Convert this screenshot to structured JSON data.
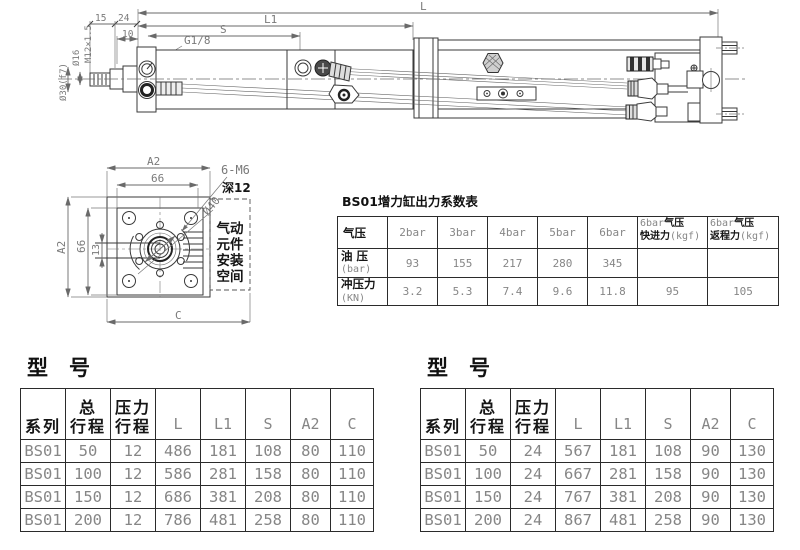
{
  "side_view": {
    "L": "L",
    "L1": "L1",
    "S": "S",
    "d10": "10",
    "d15": "15",
    "d24": "24",
    "port": "G1/8",
    "rod_thread": "M12×1.5",
    "rod_dia": "Ø16",
    "shaft_dia": "Ø30(f7)"
  },
  "end_view": {
    "a2_top": "A2",
    "w66_top": "66",
    "a2_left": "A2",
    "w66_left": "66",
    "d13": "13",
    "c": "C",
    "holes": "6-M6",
    "depth": "深12",
    "dia40": "Ø40",
    "note": [
      "气动",
      "元件",
      "安装",
      "空间"
    ]
  },
  "force_table": {
    "title": "BS01增力缸出力系数表",
    "headers": [
      "气压",
      "2bar",
      "3bar",
      "4bar",
      "5bar",
      "6bar"
    ],
    "h_fast": {
      "pre": "6bar",
      "cn1": "气压",
      "cn2": "快进力",
      "unit": "(kgf)"
    },
    "h_ret": {
      "pre": "6bar",
      "cn1": "气压",
      "cn2": "返程力",
      "unit": "(kgf)"
    },
    "row_oil": {
      "label": "油 压",
      "unit": "(bar)",
      "values": [
        "93",
        "155",
        "217",
        "280",
        "345",
        "",
        ""
      ]
    },
    "row_punch": {
      "label": "冲压力",
      "unit": "(KN)",
      "values": [
        "3.2",
        "5.3",
        "7.4",
        "9.6",
        "11.8",
        "95",
        "105"
      ]
    }
  },
  "model_tables": [
    {
      "title": "型　号",
      "headers": {
        "series": "系列",
        "stroke": "总\n行程",
        "pstroke": "压力\n行程",
        "L": "L",
        "L1": "L1",
        "S": "S",
        "A2": "A2",
        "C": "C"
      },
      "rows": [
        [
          "BS01",
          "50",
          "12",
          "486",
          "181",
          "108",
          "80",
          "110"
        ],
        [
          "BS01",
          "100",
          "12",
          "586",
          "281",
          "158",
          "80",
          "110"
        ],
        [
          "BS01",
          "150",
          "12",
          "686",
          "381",
          "208",
          "80",
          "110"
        ],
        [
          "BS01",
          "200",
          "12",
          "786",
          "481",
          "258",
          "80",
          "110"
        ]
      ]
    },
    {
      "title": "型　号",
      "headers": {
        "series": "系列",
        "stroke": "总\n行程",
        "pstroke": "压力\n行程",
        "L": "L",
        "L1": "L1",
        "S": "S",
        "A2": "A2",
        "C": "C"
      },
      "rows": [
        [
          "BS01",
          "50",
          "24",
          "567",
          "181",
          "108",
          "90",
          "130"
        ],
        [
          "BS01",
          "100",
          "24",
          "667",
          "281",
          "158",
          "90",
          "130"
        ],
        [
          "BS01",
          "150",
          "24",
          "767",
          "381",
          "208",
          "90",
          "130"
        ],
        [
          "BS01",
          "200",
          "24",
          "867",
          "481",
          "258",
          "90",
          "130"
        ]
      ]
    }
  ]
}
